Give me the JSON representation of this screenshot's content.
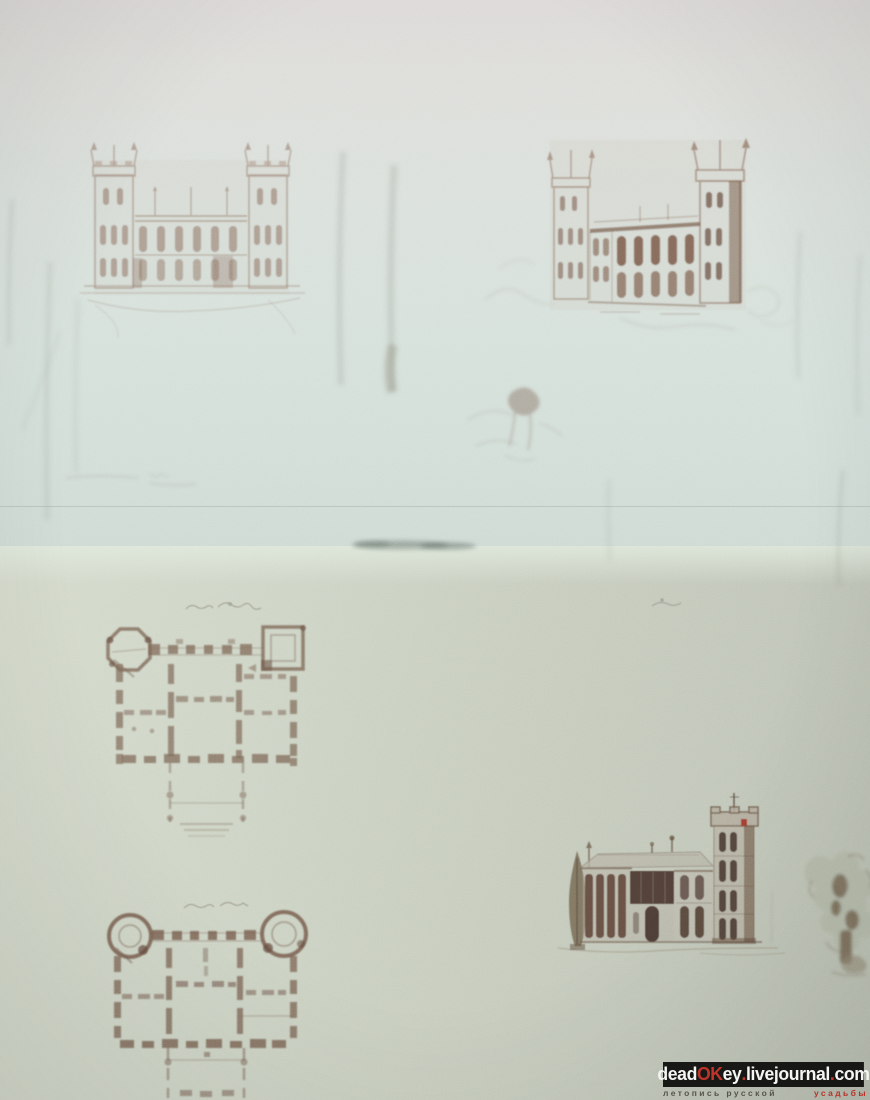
{
  "photo": {
    "description": "Photograph of an album spread with 19th-century architectural sketches in sepia watercolor",
    "top_sheet": {
      "figures": [
        {
          "name": "castle-elevation-front",
          "style": "faint sepia wash, two battlemented towers"
        },
        {
          "name": "castle-elevation-perspective",
          "style": "sepia wash, darker arcaded facade"
        },
        {
          "name": "faint-trees",
          "style": "pencil cypress and tree strokes"
        },
        {
          "name": "faint-figure-sketch",
          "style": "light pencil blob with strokes"
        }
      ]
    },
    "bottom_sheet": {
      "figures": [
        {
          "name": "floor-plan-upper",
          "style": "sepia plan, octagonal and square corner towers, dashed walls"
        },
        {
          "name": "floor-plan-lower",
          "style": "sepia plan, round corner towers, dashed walls"
        },
        {
          "name": "villa-elevation-with-tower",
          "style": "dark sepia villa, tall battlemented tower, red pennant"
        },
        {
          "name": "cypress-tree"
        },
        {
          "name": "garden-tree-and-rocks"
        }
      ],
      "captions": [
        {
          "name": "floor-plan-upper-caption",
          "legible": false
        },
        {
          "name": "floor-plan-lower-caption",
          "legible": false
        },
        {
          "name": "margin-note",
          "legible": false
        }
      ]
    }
  },
  "colors": {
    "paper_top": "#dfe0dc",
    "paper_top_mint": "#d7e3dd",
    "paper_bottom_light": "#d3dacb",
    "paper_bottom_dark": "#bfc5b7",
    "sketch_sepia": "#8d6e5c",
    "sketch_dark_brown": "#54392c",
    "pennant_red": "#a43528",
    "watermark_bar": "#0d0d0d",
    "watermark_white": "#f5f5f3",
    "watermark_red": "#c0342a"
  },
  "watermark": {
    "line1_parts": [
      {
        "text": "dead"
      },
      {
        "text": "OK"
      },
      {
        "text": "ey"
      },
      {
        "text": "."
      },
      {
        "text": "livejournal"
      },
      {
        "text": "."
      },
      {
        "text": "com"
      }
    ],
    "line2_left": "летопись русской",
    "line2_right": "усадьбы"
  }
}
